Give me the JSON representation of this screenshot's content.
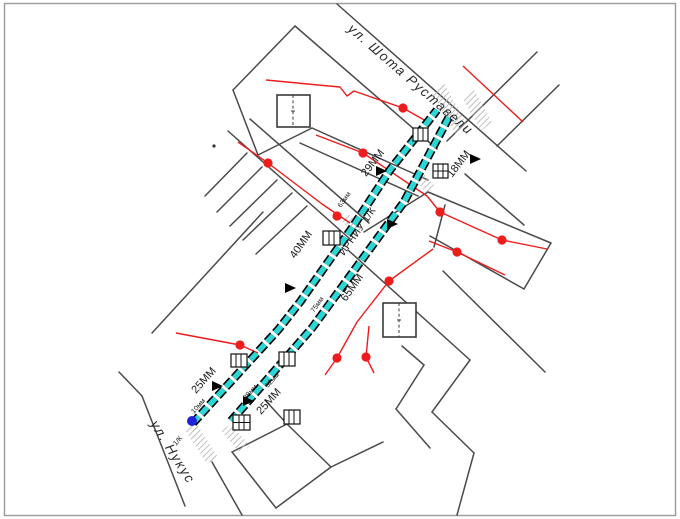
{
  "map": {
    "title_hint": "utility pipeline plan",
    "streets": {
      "rustaveli": "ул. Шота Руставели",
      "nukus": "ул. Нукус"
    },
    "pipeline_segments": {
      "seg_29": "29ММ",
      "seg_18": "18ММ",
      "seg_40": "40ММ",
      "seg_65": "65ММ",
      "seg_25_left": "25ММ",
      "seg_25_right": "25ММ",
      "route_label": "ИРНИУ 1/К"
    },
    "diameter_notes": {
      "d63": "63мм",
      "d75": "75мм",
      "d38": "38мм",
      "d32": "32мм",
      "d10": "10мм",
      "kk_note": "1/К"
    },
    "colors": {
      "pipeline": "#2bd6d6",
      "pipeline_casing": "#000000",
      "street": "#4a4a4a",
      "utility_line": "#ee1c1c",
      "node_dot": "#ee1c1c",
      "start_node_dot": "#2222dd",
      "crossing_hatch": "#b5b5b5",
      "page_border": "#9a9a9a",
      "text": "#1a1a1a"
    }
  }
}
